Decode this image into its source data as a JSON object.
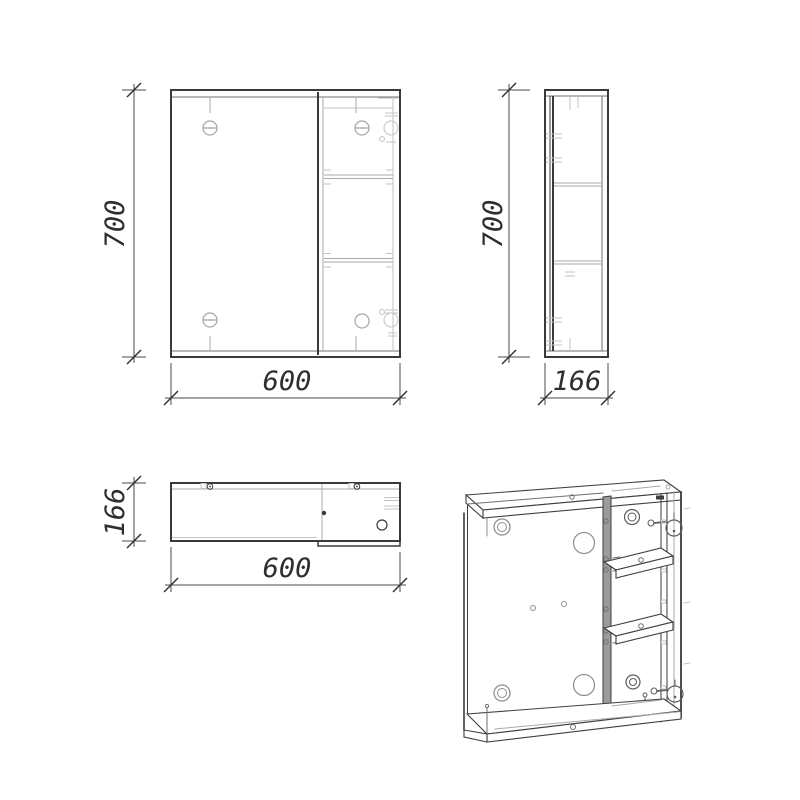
{
  "dimensions": {
    "front_height": "700",
    "front_width": "600",
    "side_height": "700",
    "side_depth": "166",
    "top_depth": "166",
    "top_width": "600"
  },
  "colors": {
    "background": "#ffffff",
    "line_dark": "#3a3a3a",
    "line_light": "#a9a9a9",
    "dimension_text": "#2e2e2e"
  }
}
